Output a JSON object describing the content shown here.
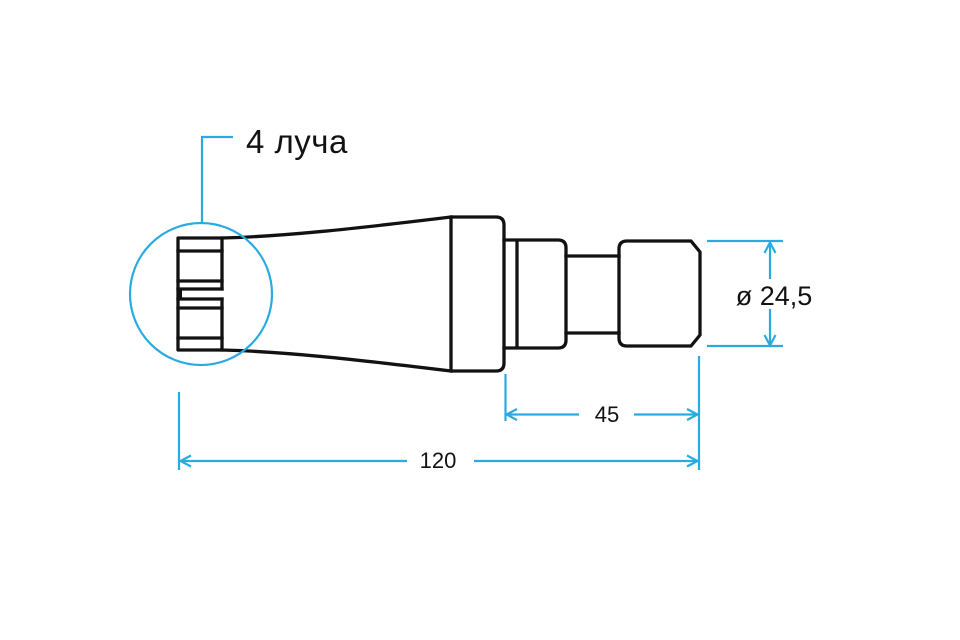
{
  "callout": {
    "label": "4 луча"
  },
  "dimensions": {
    "overall_length": "120",
    "section_length": "45",
    "diameter": "ø 24,5"
  },
  "colors": {
    "outline_black": "#121212",
    "dimension_blue": "#29ABE2",
    "background": "#ffffff"
  }
}
